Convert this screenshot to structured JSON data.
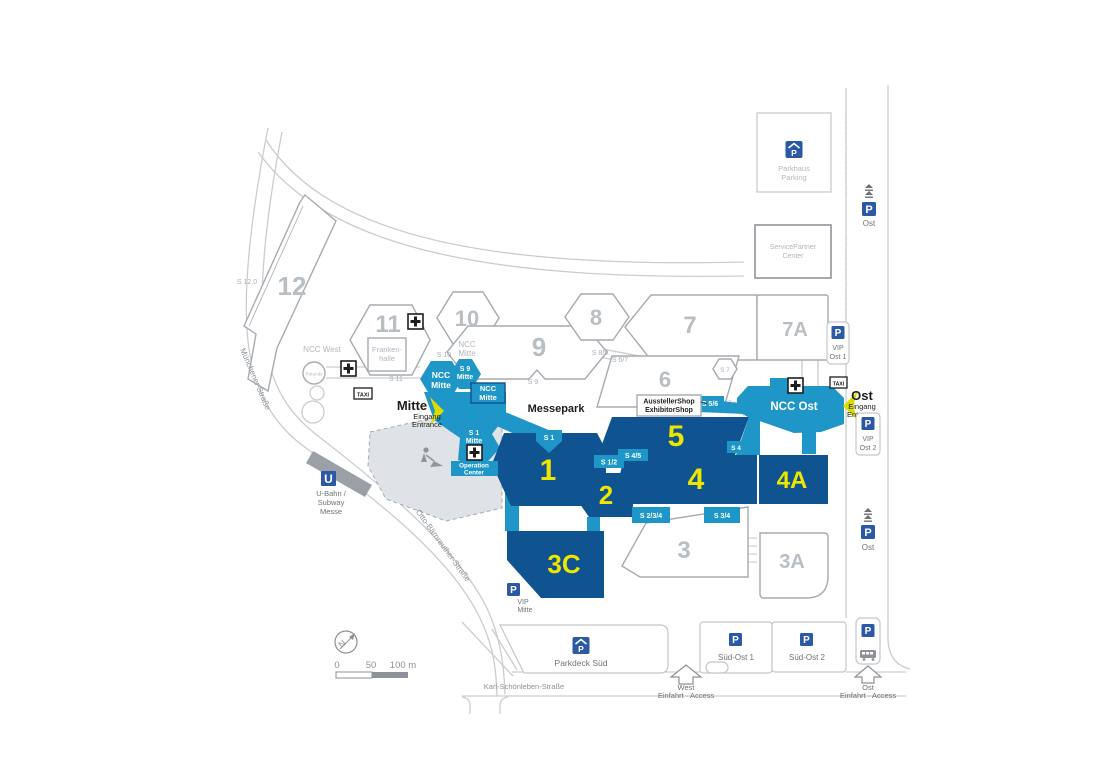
{
  "halls": {
    "h1": "1",
    "h2": "2",
    "h3": "3",
    "h3a": "3A",
    "h3c": "3C",
    "h4": "4",
    "h4a": "4A",
    "h5": "5",
    "h6": "6",
    "h7": "7",
    "h7a": "7A",
    "h8": "8",
    "h9": "9",
    "h10": "10",
    "h11": "11",
    "h12": "12"
  },
  "buildings": {
    "parkhaus": [
      "Parkhaus",
      "Parking"
    ],
    "service_partner": [
      "ServicePartner",
      "Center"
    ],
    "frankenhalle": [
      "Franken-",
      "halle"
    ],
    "rotunde": "Rotunde",
    "ncc_west": "NCC West",
    "ncc_mitte_outline": [
      "NCC",
      "Mitte"
    ],
    "ncc_mitte_hex": [
      "NCC",
      "Mitte"
    ],
    "s9_mitte": [
      "S 9",
      "Mitte"
    ],
    "ncc_mitte_rect": [
      "NCC",
      "Mitte"
    ],
    "s1_mitte": [
      "S 1",
      "Mitte"
    ],
    "operation_center": [
      "Operation",
      "Center"
    ],
    "ncc_ost": "NCC Ost",
    "messepark": "Messepark",
    "exhibitor_shop": [
      "AusstellerShop",
      "ExhibitorShop"
    ]
  },
  "service_labels": {
    "s12_0": "S 12.0",
    "s11": "S 11",
    "s10": "S 10",
    "s9": "S 9",
    "s8_9": "S 8/9",
    "s6_7": "S 6/7",
    "s7": "S 7"
  },
  "gate_labels": {
    "s1": "S 1",
    "s1_2": "S 1/2",
    "s4_5": "S 4/5",
    "s4": "S 4",
    "s5_6": "S 5/6",
    "s2_3_4": "S 2/3/4",
    "s3_4": "S 3/4"
  },
  "entrances": {
    "mitte": [
      "Mitte",
      "Eingang",
      "Entrance"
    ],
    "ost": [
      "Ost",
      "Eingang",
      "Entrance"
    ]
  },
  "parking": {
    "p": "P",
    "ost_top": "Ost",
    "vip_ost1": [
      "VIP",
      "Ost 1"
    ],
    "vip_ost2": [
      "VIP",
      "Ost 2"
    ],
    "ost_mid": "Ost",
    "vip_mitte": [
      "VIP",
      "Mitte"
    ],
    "parkdeck_sued": "Parkdeck Süd",
    "sued_ost1": "Süd-Ost 1",
    "sued_ost2": "Süd-Ost 2"
  },
  "access": {
    "west": [
      "West",
      "Einfahrt · Access"
    ],
    "ost": [
      "Ost",
      "Einfahrt · Access"
    ]
  },
  "streets": {
    "muenchener": "Münchener Straße",
    "otto": "Otto-Bärnreuther-Straße",
    "karl": "Karl-Schönleben-Straße"
  },
  "transit": {
    "u": "U",
    "label": [
      "U-Bahn /",
      "Subway",
      "Messe"
    ]
  },
  "taxi": "TAXI",
  "scale": {
    "start": "0",
    "mid": "50",
    "end": "100 m"
  },
  "compass": "N",
  "colors": {
    "hall_navy": "#0f5390",
    "ncc_teal": "#1e96c8",
    "number_yellow": "#ece600",
    "sign_blue": "#2b59a5",
    "entrance_yellow": "#dcdc00",
    "outline_gray": "#a6abb0",
    "road_gray": "#c9cdd0"
  }
}
